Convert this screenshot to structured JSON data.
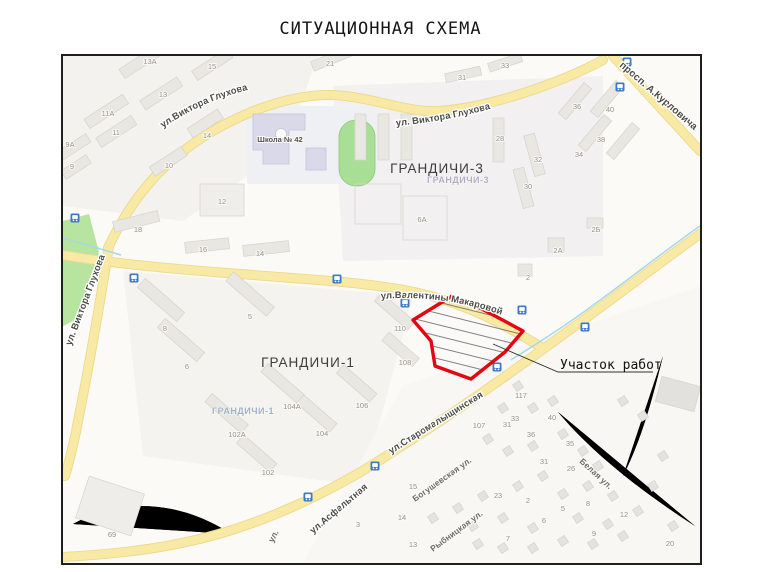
{
  "title": "СИТУАЦИОННАЯ СХЕМА",
  "map": {
    "annotation": {
      "work_area_label": "Участок работ"
    },
    "districts": [
      "ГРАНДИЧИ-3",
      "ГРАНДИЧИ-3",
      "ГРАНДИЧИ-1",
      "ГРАНДИЧИ-1"
    ],
    "poi": [
      "Школа № 42"
    ],
    "streets": [
      "ул.Виктора Глухова",
      "ул. Виктора Глухова",
      "просп. А.Курловича",
      "ул. Виктора Глухова",
      "ул.Валентины Макаровой",
      "ул.Старомалыщинская",
      "ул.Асфальтная",
      "Богушевская ул.",
      "Рыбницкая ул.",
      "Белая ул.",
      "ул."
    ],
    "house_numbers": [
      "13А",
      "15",
      "13",
      "11А",
      "11",
      "9А",
      "9",
      "14",
      "10",
      "12",
      "18",
      "16",
      "14",
      "21",
      "31",
      "33",
      "28",
      "36",
      "40",
      "38",
      "32",
      "34",
      "30",
      "6А",
      "2Б",
      "2А",
      "2",
      "8",
      "6",
      "5",
      "110",
      "108",
      "104А",
      "106",
      "104",
      "102А",
      "102",
      "69",
      "117",
      "107",
      "31",
      "33",
      "36",
      "40",
      "35",
      "31",
      "26",
      "23",
      "2",
      "15",
      "14",
      "3",
      "13",
      "5",
      "6",
      "8",
      "7",
      "9",
      "12",
      "20"
    ],
    "colors": {
      "road_yellow": "#f8e9a4",
      "work_area_red": "#e30613",
      "bus_icon_blue": "#3b7ac7",
      "park_green": "#b7e49e",
      "stadium_green": "#a9de96",
      "school_fill": "#d9d9ea",
      "stream_blue": "#a6d8e8"
    }
  }
}
